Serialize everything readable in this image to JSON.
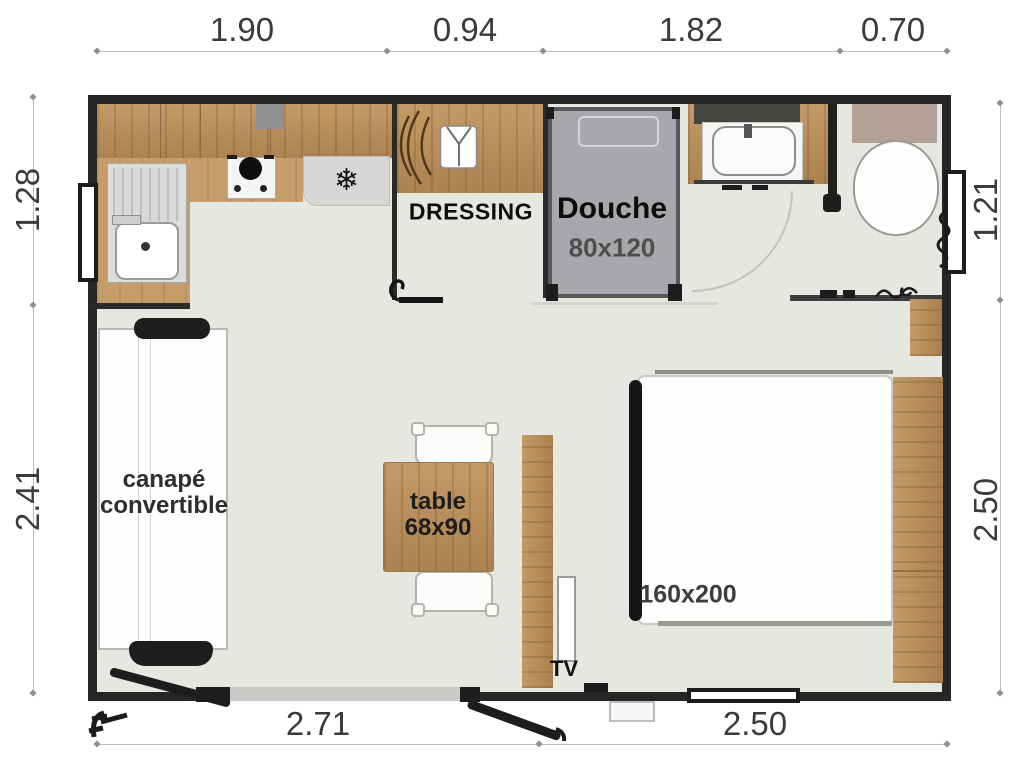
{
  "plan": {
    "title": "mobile-home floor plan",
    "rooms": {
      "dressing_label": "DRESSING",
      "shower_label": "Douche",
      "shower_size": "80x120",
      "sofa_label_line1": "canapé",
      "sofa_label_line2": "convertible",
      "table_label_line1": "table",
      "table_label_line2": "68x90",
      "bed_size": "160x200",
      "tv_label": "TV"
    },
    "dimensions": {
      "top": [
        "1.90",
        "0.94",
        "1.82",
        "0.70"
      ],
      "left": [
        "1.28",
        "2.41"
      ],
      "right": [
        "1.21",
        "2.50"
      ],
      "bottom": [
        "2.71",
        "2.50"
      ]
    },
    "icons": {
      "fridge_glyph": "❄",
      "fridge_icon": "snowflake-icon",
      "wardrobe_icon": "shirt-icon"
    },
    "colors": {
      "wall": "#262626",
      "floor": "#e7e7e2",
      "wood": "#b9905c",
      "shower_gray": "#a8a8ac",
      "cistern_taupe": "#b3a196",
      "fridge_gray": "#d6d6d4",
      "backsplash": "#46443f"
    }
  }
}
